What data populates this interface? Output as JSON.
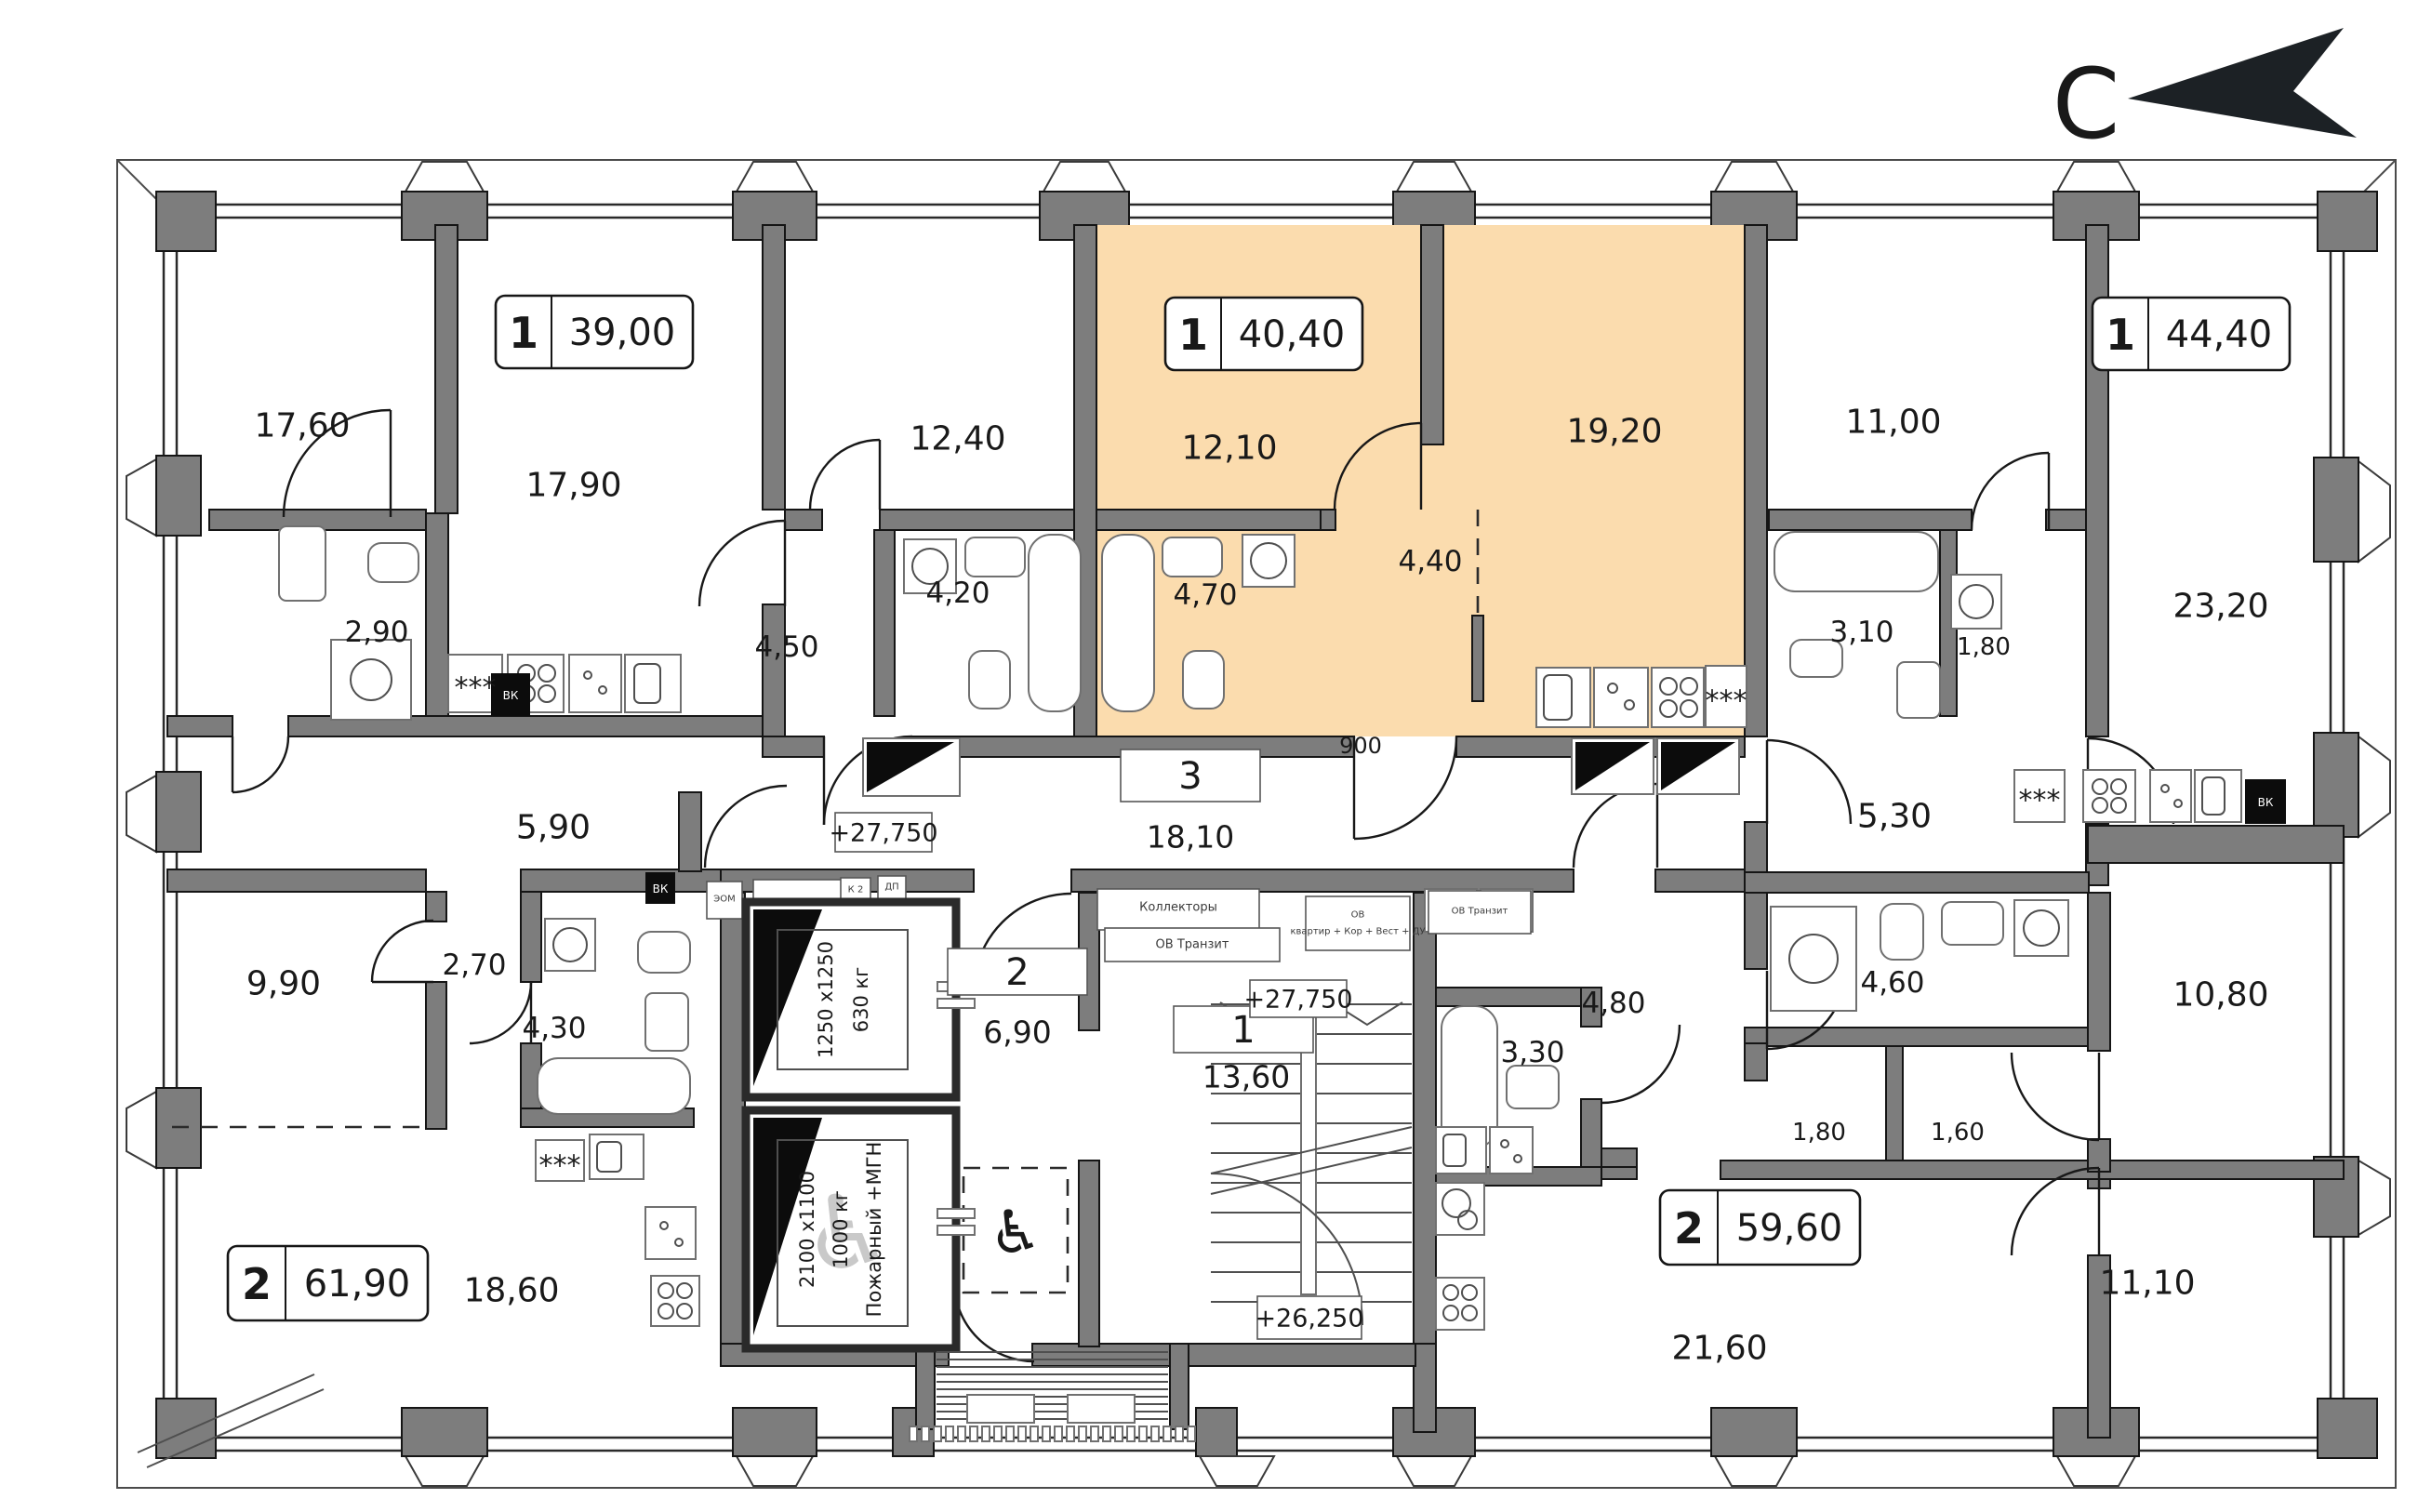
{
  "compass": {
    "label": "С"
  },
  "apartments": {
    "a39": {
      "type": "1",
      "area": "39,00"
    },
    "a40": {
      "type": "1",
      "area": "40,40"
    },
    "a44": {
      "type": "1",
      "area": "44,40"
    },
    "a61": {
      "type": "2",
      "area": "61,90"
    },
    "a59": {
      "type": "2",
      "area": "59,60"
    }
  },
  "units": {
    "corridor": {
      "number": "3",
      "area": "18,10"
    },
    "lobby": {
      "number": "2",
      "area": "6,90"
    },
    "stair_hall": {
      "number": "1",
      "area": "13,60"
    }
  },
  "rooms": {
    "r17_60": "17,60",
    "r17_90": "17,90",
    "r2_90": "2,90",
    "r12_40": "12,40",
    "r4_20": "4,20",
    "r4_50": "4,50",
    "r12_10": "12,10",
    "r4_70": "4,70",
    "r4_40": "4,40",
    "r19_20": "19,20",
    "r11_00": "11,00",
    "r3_10": "3,10",
    "r1_80a": "1,80",
    "r23_20": "23,20",
    "r5_30": "5,30",
    "r5_90": "5,90",
    "r9_90": "9,90",
    "r2_70": "2,70",
    "r4_30": "4,30",
    "r18_60": "18,60",
    "r4_80": "4,80",
    "r4_60": "4,60",
    "r10_80": "10,80",
    "r1_80b": "1,80",
    "r1_60": "1,60",
    "r3_30": "3,30",
    "r21_60": "21,60",
    "r11_10": "11,10"
  },
  "levels": {
    "corridor": "+27,750",
    "hall": "+27,750",
    "stairs": "+26,250"
  },
  "dims": {
    "door": "900"
  },
  "elevators": {
    "passenger": {
      "size": "1250 х1250",
      "capacity": "630 кг"
    },
    "fire": {
      "size": "2100 х1100",
      "capacity": "1000 кг",
      "note": "Пожарный +МГН"
    }
  },
  "tech": {
    "collectors": "Коллекторы",
    "ov_transit_a": "ОВ Транзит",
    "ov_line1": "ОВ",
    "ov_line2": "квартир + Кор + Вест + ДУ",
    "ov_transit_b": "ОВ Транзит",
    "kdu": "КДУ + Пкор",
    "eom": "ЭОМ",
    "k2": "К 2",
    "dp": "ДП",
    "vk_a": "ВК",
    "vk_b": "ВК",
    "vk_c": "ВК",
    "fridge1": "***",
    "fridge2": "***",
    "fridge3": "***",
    "fridge4": "***"
  },
  "colors": {
    "highlight": "#fbdcae",
    "wall": "#7d7d7d",
    "line": "#1a1a1a",
    "arrow": "#1c2125"
  }
}
